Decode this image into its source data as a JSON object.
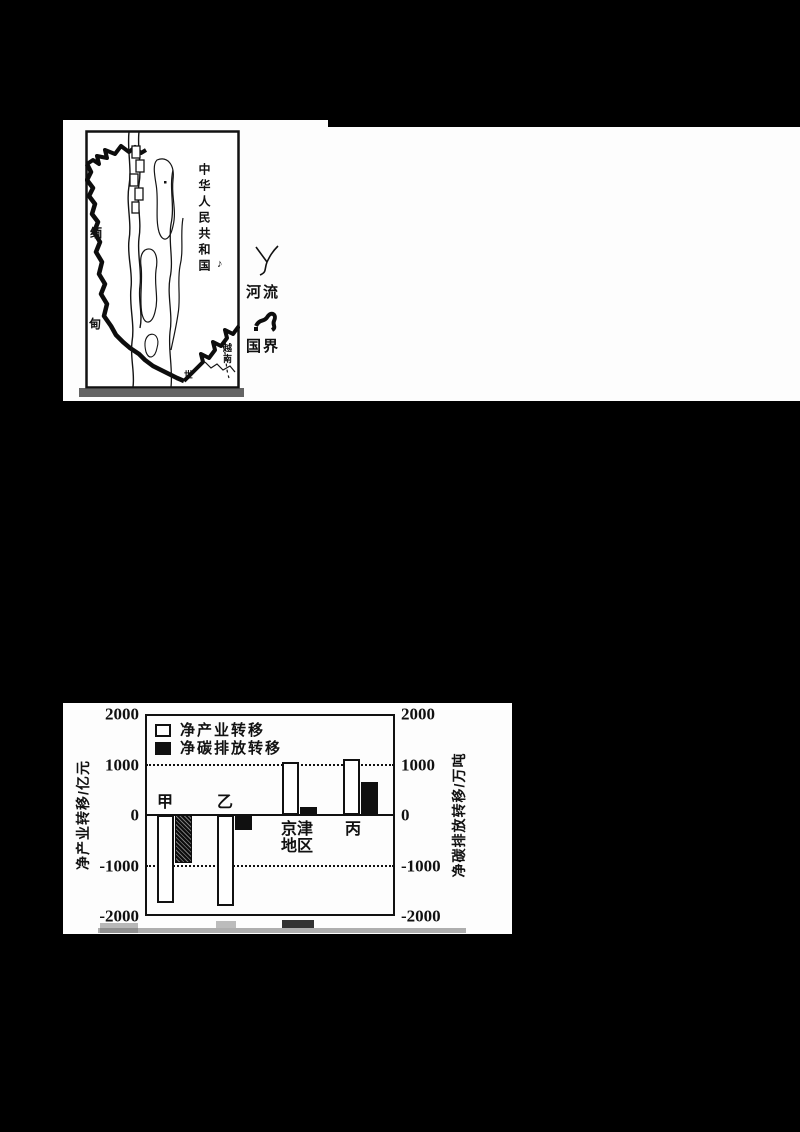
{
  "figure_top": {
    "map": {
      "country_right_vertical": "中华人民共和国",
      "country_left_char_top": "缅",
      "country_left_char_bottom": "甸",
      "country_bottom_right_vertical": "越南",
      "bottom_edge_char": "世",
      "small_glyph": "♪"
    },
    "legend": {
      "river_label": "河流",
      "border_label": "国界"
    }
  },
  "chart_data": {
    "type": "bar",
    "categories": [
      "甲",
      "乙",
      "京津地区",
      "丙"
    ],
    "series": [
      {
        "name": "净产业转移",
        "unit": "亿元",
        "values": [
          -1750,
          -1800,
          1050,
          1100
        ],
        "style": "white-outline"
      },
      {
        "name": "净碳排放转移",
        "unit": "万吨",
        "values": [
          -950,
          -300,
          150,
          650
        ],
        "style": "dark"
      }
    ],
    "left_axis_label": "净产业转移/亿元",
    "right_axis_label": "净碳排放转移/万吨",
    "yticks": [
      2000,
      1000,
      0,
      -1000,
      -2000
    ],
    "ylim": [
      -2000,
      2000
    ],
    "dotted_gridlines": [
      1000,
      -1000
    ],
    "legend_position": "top-left-inside",
    "grid": "dotted-at-plus-minus-1000"
  }
}
